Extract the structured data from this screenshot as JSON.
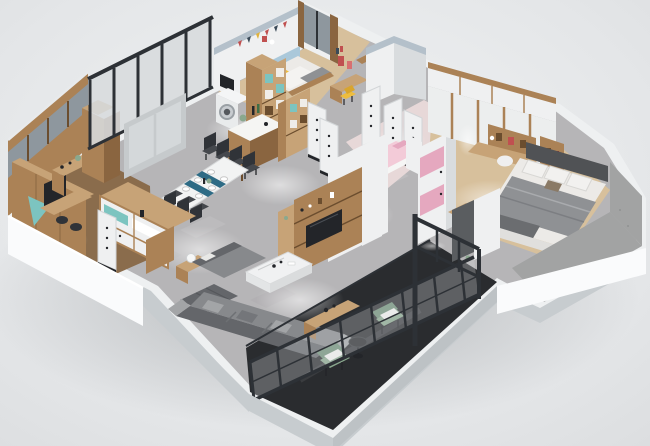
{
  "canvas": {
    "width": 650,
    "height": 446
  },
  "scene": {
    "description": "3D isometric cutaway render of a furnished apartment floor plan on a plain light-gray studio background",
    "view": "isometric bird's-eye",
    "visible_text": "none"
  },
  "rooms": {
    "study": {
      "label": "study nook with wood partition walls, desk and bar counter"
    },
    "dining": {
      "label": "dining area with white table, blue runner and dark chairs"
    },
    "kitchen": {
      "label": "kitchen with island counter and tall wood shelf"
    },
    "laundry": {
      "label": "laundry corner with washing machine"
    },
    "kids_bedroom": {
      "label": "kids bedroom with yellow-pillow bed, bunting wall and bookshelf"
    },
    "pink_bedroom": {
      "label": "pink bedroom with pink bed and pink-white wardrobe"
    },
    "hallway": {
      "label": "hallway with white doors"
    },
    "master_bedroom": {
      "label": "master bedroom with gray bed, wardrobe and corner desk"
    },
    "living": {
      "label": "living room with gray sectional sofa and marble coffee table"
    },
    "balcony": {
      "label": "glazed balcony with black metal frame and green armchairs"
    }
  },
  "palette": {
    "bg1": "#f1f3f4",
    "bg2": "#dcdee0",
    "slabTop": "#eef0f1",
    "slabSide": "#c7cccf",
    "plinth": "#fafbfc",
    "marble": "#b6b5b7",
    "woodFloor": "#d7c09c",
    "officeFloor": "#8a6c4c",
    "pinkFloor": "#e7d8d8",
    "balconyFloor": "#2a2c2f",
    "wood": "#ab8256",
    "woodLight": "#c7a377",
    "woodDark": "#8a6540",
    "woodDeep": "#6b4d2e",
    "white": "#eff0f1",
    "whiteShade": "#d9dcde",
    "cap": "#b4c0ca",
    "glass": "#d7dbdd",
    "glassDark": "#8e979e",
    "frame": "#2d3136",
    "teal": "#7cc4c0",
    "blueWall": "#aac8da",
    "runner": "#2e6b85",
    "yellow": "#eebd3e",
    "pinkLight": "#f3cbd8",
    "pinkMid": "#e5a8bf",
    "sofa": "#87898c",
    "sofaDark": "#64666a",
    "sofaLight": "#a3a5a7",
    "bedWhite": "#eceae7",
    "blanket": "#8f9194",
    "headboard": "#505255",
    "green": "#8aa88e",
    "greenDark": "#6f9077",
    "marbleTable": "#f0f1f2",
    "dark": "#232529",
    "pad": "#a2a3a3",
    "chair": "#45484d",
    "chairBack": "#303338"
  }
}
